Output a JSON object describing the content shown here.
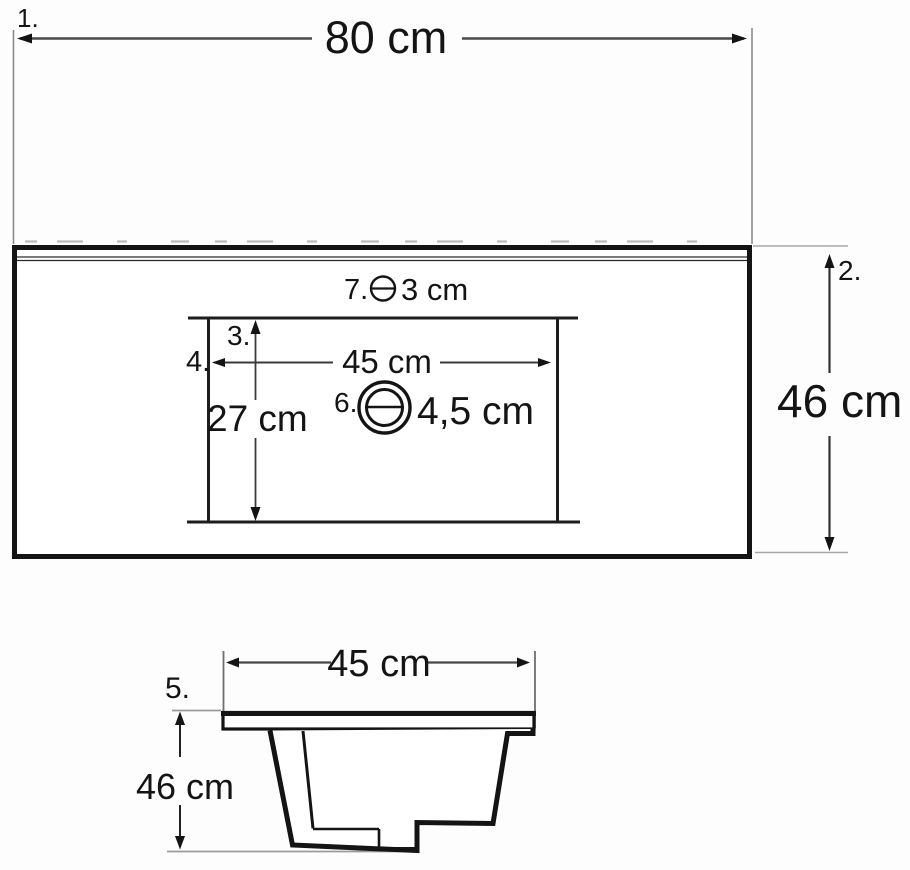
{
  "drawing": {
    "title_semantic": "washbasin dimension drawing",
    "colors": {
      "outline": "#141414",
      "dimension_line": "#4a4a4a",
      "extension_line": "#9a9a9a",
      "background": "#fdfdfd"
    },
    "top_view": {
      "overall_width_dim": {
        "index_label": "1.",
        "value": "80 cm"
      },
      "overall_depth_dim": {
        "index_label": "2.",
        "value": "46 cm"
      },
      "basin_depth_dim": {
        "index_label": "3.",
        "value": "27 cm"
      },
      "basin_width_dim": {
        "index_label": "4.",
        "value": "45 cm"
      },
      "drain_callout": {
        "index_label": "6.",
        "value": "4,5 cm"
      },
      "overflow_callout": {
        "index_label": "7.",
        "value": "3 cm"
      }
    },
    "side_view": {
      "basin_width_dim": {
        "value": "45 cm"
      },
      "basin_height_dim": {
        "index_label": "5.",
        "value": "46 cm"
      }
    }
  }
}
